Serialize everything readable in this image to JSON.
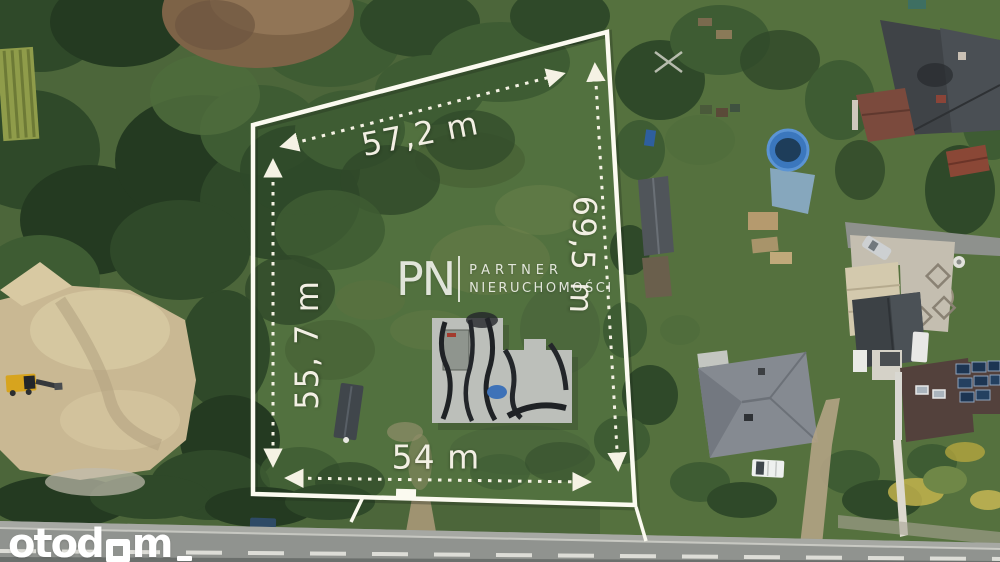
{
  "measurements": {
    "top": "57,2 m",
    "right": "69,5 m",
    "left": "55, 7 m",
    "bottom": "54 m"
  },
  "watermarks": {
    "agency_initials": "PN",
    "agency_line1": "PARTNER",
    "agency_line2": "NIERUCHOMOŚCI",
    "portal_full": "otodom",
    "portal_prefix": "otod",
    "portal_suffix": "m"
  },
  "colors": {
    "boundary_line": "#fbfaf0",
    "dimension_text": "#f2efe3",
    "watermark_white": "#ffffff",
    "grass_green": "#52713f",
    "forest_green": "#2f4929",
    "sand_tan": "#c9b893",
    "road_gray": "#90938f",
    "pool_blue": "#3b77bd",
    "roof_gray": "#3f4347",
    "foundation_gray": "#bcbfba"
  }
}
